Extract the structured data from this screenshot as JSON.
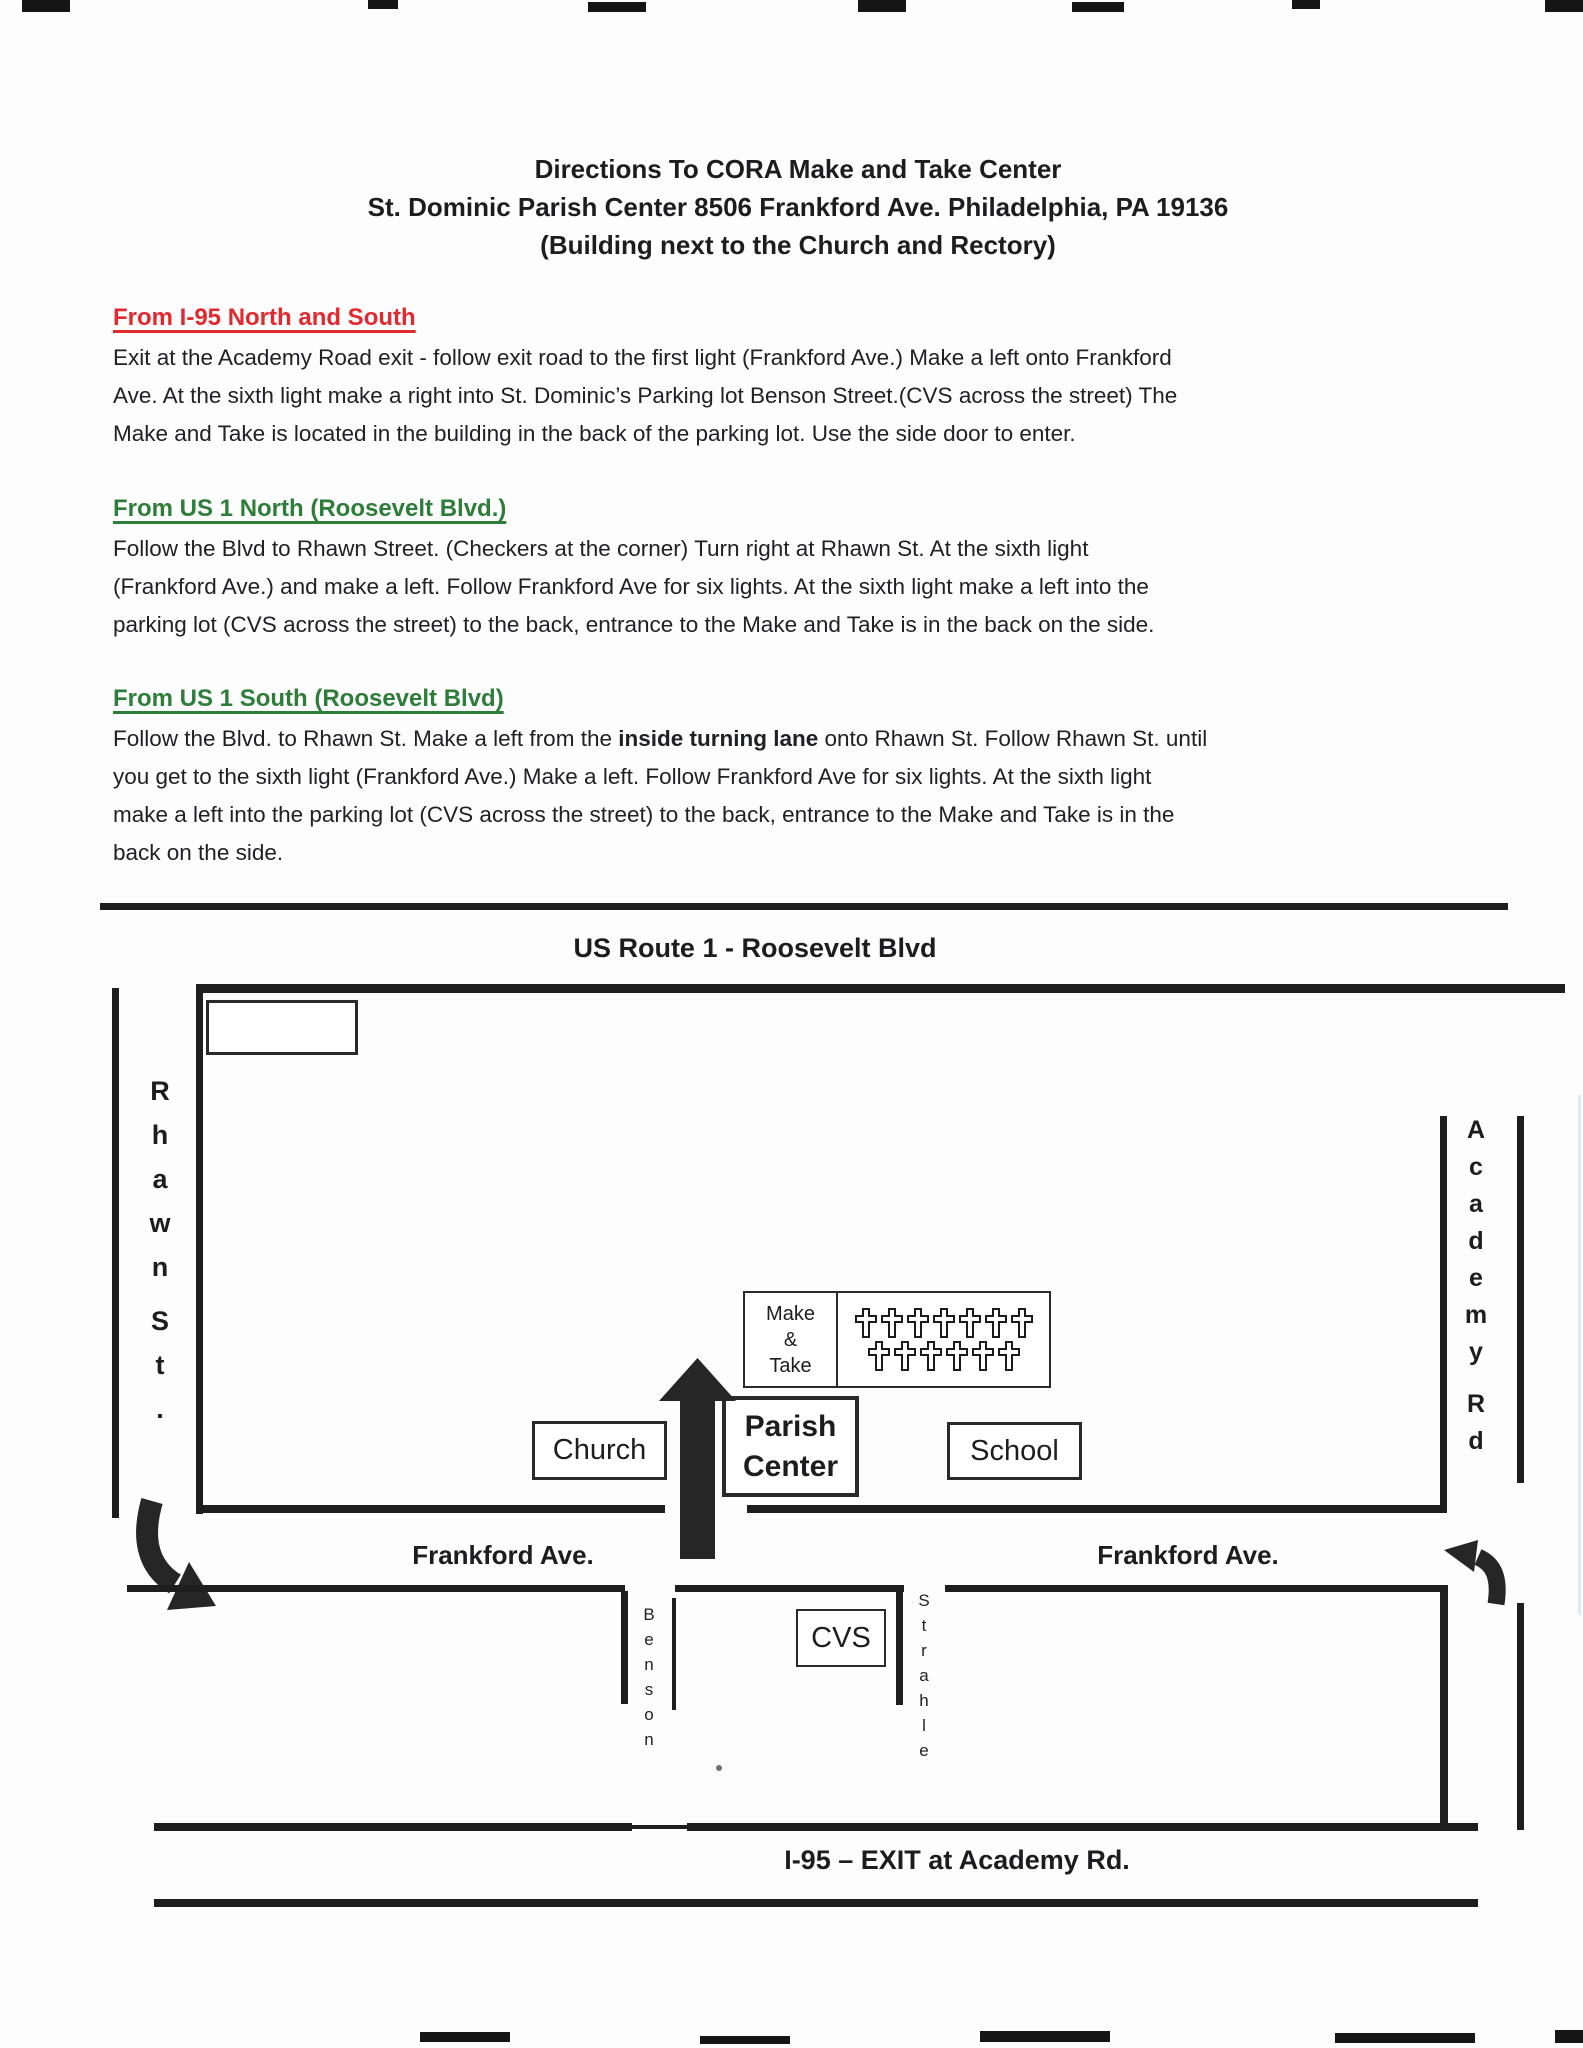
{
  "header": {
    "title_line1": "Directions To CORA Make and Take Center",
    "title_line2": "St. Dominic Parish Center 8506 Frankford Ave. Philadelphia, PA 19136",
    "title_line3": "(Building next to the Church and Rectory)"
  },
  "colors": {
    "red_heading": "#e02a30",
    "green_heading": "#2f7d3a",
    "ink": "#1e1e1e"
  },
  "sections": [
    {
      "heading": "From I-95 North and South",
      "heading_color": "#e02a30",
      "lines": [
        [
          {
            "t": "Exit at the Academy Road exit - follow exit road to the first light (Frankford Ave.) Make a left onto Frankford"
          }
        ],
        [
          {
            "t": "Ave. At the sixth light make a right into St. Dominic’s Parking lot Benson Street.(CVS across the street) The"
          }
        ],
        [
          {
            "t": "Make and Take is located in the building in the back of the parking lot. Use the side door to enter."
          }
        ]
      ]
    },
    {
      "heading": "From US 1 North (Roosevelt Blvd.)",
      "heading_color": "#2f7d3a",
      "lines": [
        [
          {
            "t": "Follow the Blvd to Rhawn Street. (Checkers at the corner) Turn right at Rhawn St. At the sixth light"
          }
        ],
        [
          {
            "t": "(Frankford Ave.) and make a left. Follow Frankford Ave for six lights. At the sixth light make a left into the"
          }
        ],
        [
          {
            "t": "parking lot (CVS across the street) to the back, entrance to the Make and Take is in the back on the side."
          }
        ]
      ]
    },
    {
      "heading": "From US 1 South (Roosevelt Blvd)",
      "heading_color": "#2f7d3a",
      "lines": [
        [
          {
            "t": "Follow the Blvd. to Rhawn St. Make a left from the "
          },
          {
            "t": "inside turning lane",
            "b": true
          },
          {
            "t": " onto Rhawn St. Follow Rhawn St. until"
          }
        ],
        [
          {
            "t": "you get to the sixth light (Frankford Ave.) Make a left. Follow Frankford Ave for six lights. At the sixth light"
          }
        ],
        [
          {
            "t": "make a left into the parking lot (CVS across the street) to the back, entrance to the Make and Take is in the"
          }
        ],
        [
          {
            "t": "back on the side."
          }
        ]
      ]
    }
  ],
  "map": {
    "roosevelt_label": "US Route 1 - Roosevelt Blvd",
    "rhawn_word": "Rhawn",
    "st_word": "St.",
    "academy_word": "Academy",
    "rd_word": "Rd",
    "benson_word": "Benson",
    "strahle_word": "Strahle",
    "make_take_line1": "Make",
    "make_take_line2": "&",
    "make_take_line3": "Take",
    "parish_line1": "Parish",
    "parish_line2": "Center",
    "church_label": "Church",
    "school_label": "School",
    "cvs_label": "CVS",
    "frankford_left_label": "Frankford Ave.",
    "frankford_right_label": "Frankford Ave.",
    "i95_label": "I-95 – EXIT at Academy Rd.",
    "crosses_rows": [
      7,
      6
    ]
  }
}
